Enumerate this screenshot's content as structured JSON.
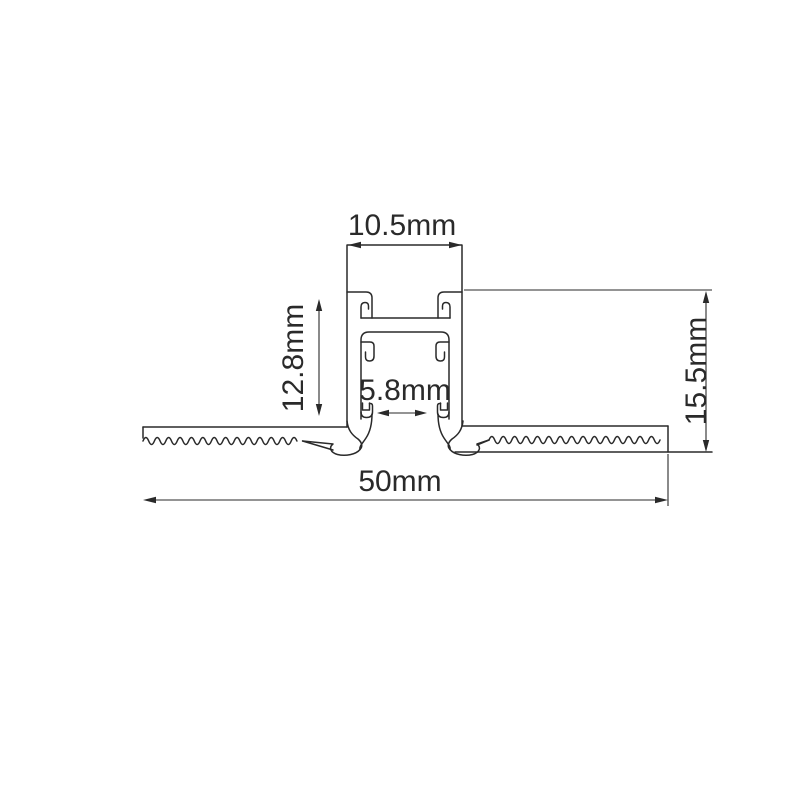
{
  "page": {
    "background": "#ffffff"
  },
  "diagram": {
    "kind": "aluminium-led-profile-cross-section",
    "line_color": "#2a2a2a",
    "labels": {
      "top_width": "10.5mm",
      "body_height": "12.8mm",
      "slot_width": "5.8mm",
      "recess_height": "15.5mm",
      "overall_width": "50mm"
    }
  }
}
